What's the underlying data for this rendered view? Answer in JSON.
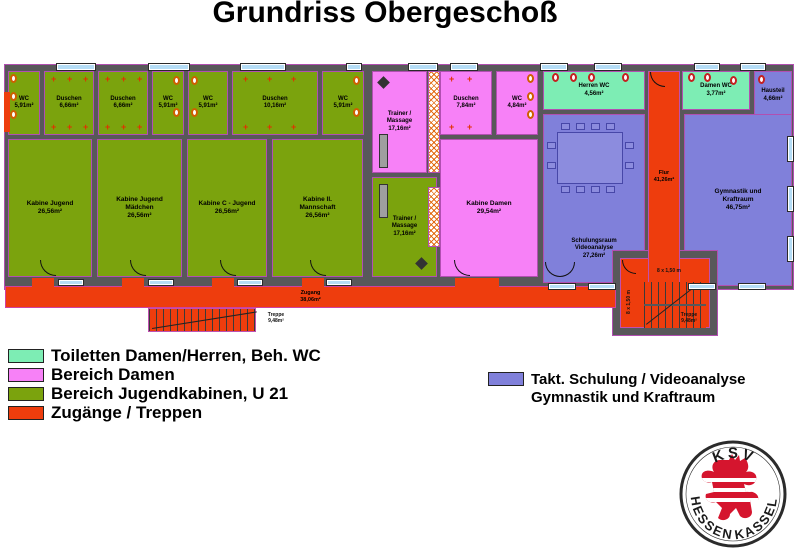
{
  "title": "Grundriss Obergeschoß",
  "rooms": {
    "wc_a": {
      "name": "WC",
      "area": "5,91m²"
    },
    "du_a": {
      "name": "Duschen",
      "area": "6,66m²"
    },
    "du_b": {
      "name": "Duschen",
      "area": "6,66m²"
    },
    "wc_b": {
      "name": "WC",
      "area": "5,91m²"
    },
    "wc_c": {
      "name": "WC",
      "area": "5,91m²"
    },
    "du_c": {
      "name": "Duschen",
      "area": "10,16m²"
    },
    "wc_d": {
      "name": "WC",
      "area": "5,91m²"
    },
    "kab1": {
      "name": "Kabine Jugend",
      "area": "26,56m²"
    },
    "kab2": {
      "name": "Kabine Jugend Mädchen",
      "area": "26,56m²"
    },
    "kab3": {
      "name": "Kabine C - Jugend",
      "area": "26,56m²"
    },
    "kab4": {
      "name": "Kabine II. Mannschaft",
      "area": "26,56m²"
    },
    "trainer1": {
      "name": "Trainer / Massage",
      "area": "17,16m²"
    },
    "trainer2": {
      "name": "Trainer / Massage",
      "area": "17,16m²"
    },
    "du_damen": {
      "name": "Duschen",
      "area": "7,84m²"
    },
    "wc_damen": {
      "name": "WC",
      "area": "4,84m²"
    },
    "kab_damen": {
      "name": "Kabine Damen",
      "area": "29,54m²"
    },
    "herren_wc": {
      "name": "Herren WC",
      "area": "4,56m²"
    },
    "damen_wc": {
      "name": "Damen WC",
      "area": "3,77m²"
    },
    "hausteil": {
      "name": "Hausteil",
      "area": "4,66m²"
    },
    "schulung": {
      "name": "Schulungsraum Videoanalyse",
      "area": "27,26m²"
    },
    "gym": {
      "name": "Gymnastik und Kraftraum",
      "area": "46,75m²"
    },
    "flur": {
      "name": "Flur",
      "area": "41,26m²"
    },
    "zugang": {
      "name": "Zugang",
      "area": "38,06m²"
    },
    "treppe_links": {
      "name": "Treppe",
      "area": "9,48m²"
    },
    "treppe_rechts": {
      "name": "Treppe",
      "area": "9,48m²"
    },
    "stair_note": "8 x 1,50 m"
  },
  "legend": {
    "items": [
      {
        "label": "Toiletten Damen/Herren, Beh. WC",
        "color": "#7dedb4"
      },
      {
        "label": "Bereich Damen",
        "color": "#f781f7"
      },
      {
        "label": "Bereich Jugendkabinen, U 21",
        "color": "#7ba30d"
      },
      {
        "label": "Zugänge / Treppen",
        "color": "#ee3d0d"
      }
    ],
    "right": {
      "color": "#8080da",
      "line1": "Takt. Schulung / Videoanalyse",
      "line2": "Gymnastik und Kraftraum"
    }
  },
  "logo": {
    "top": "KSV",
    "bottom_left": "HESSEN",
    "bottom_right": "KASSEL"
  },
  "colors": {
    "wall": "#58585a",
    "outline": "#b14fb1",
    "window": "#b5ddf6",
    "toilets_zone": "#7dedb4",
    "damen_zone": "#f781f7",
    "jugend_zone": "#7ba30d",
    "zugang_zone": "#ee3d0d",
    "schulung_zone": "#8080da",
    "lion_red": "#d5152e"
  }
}
